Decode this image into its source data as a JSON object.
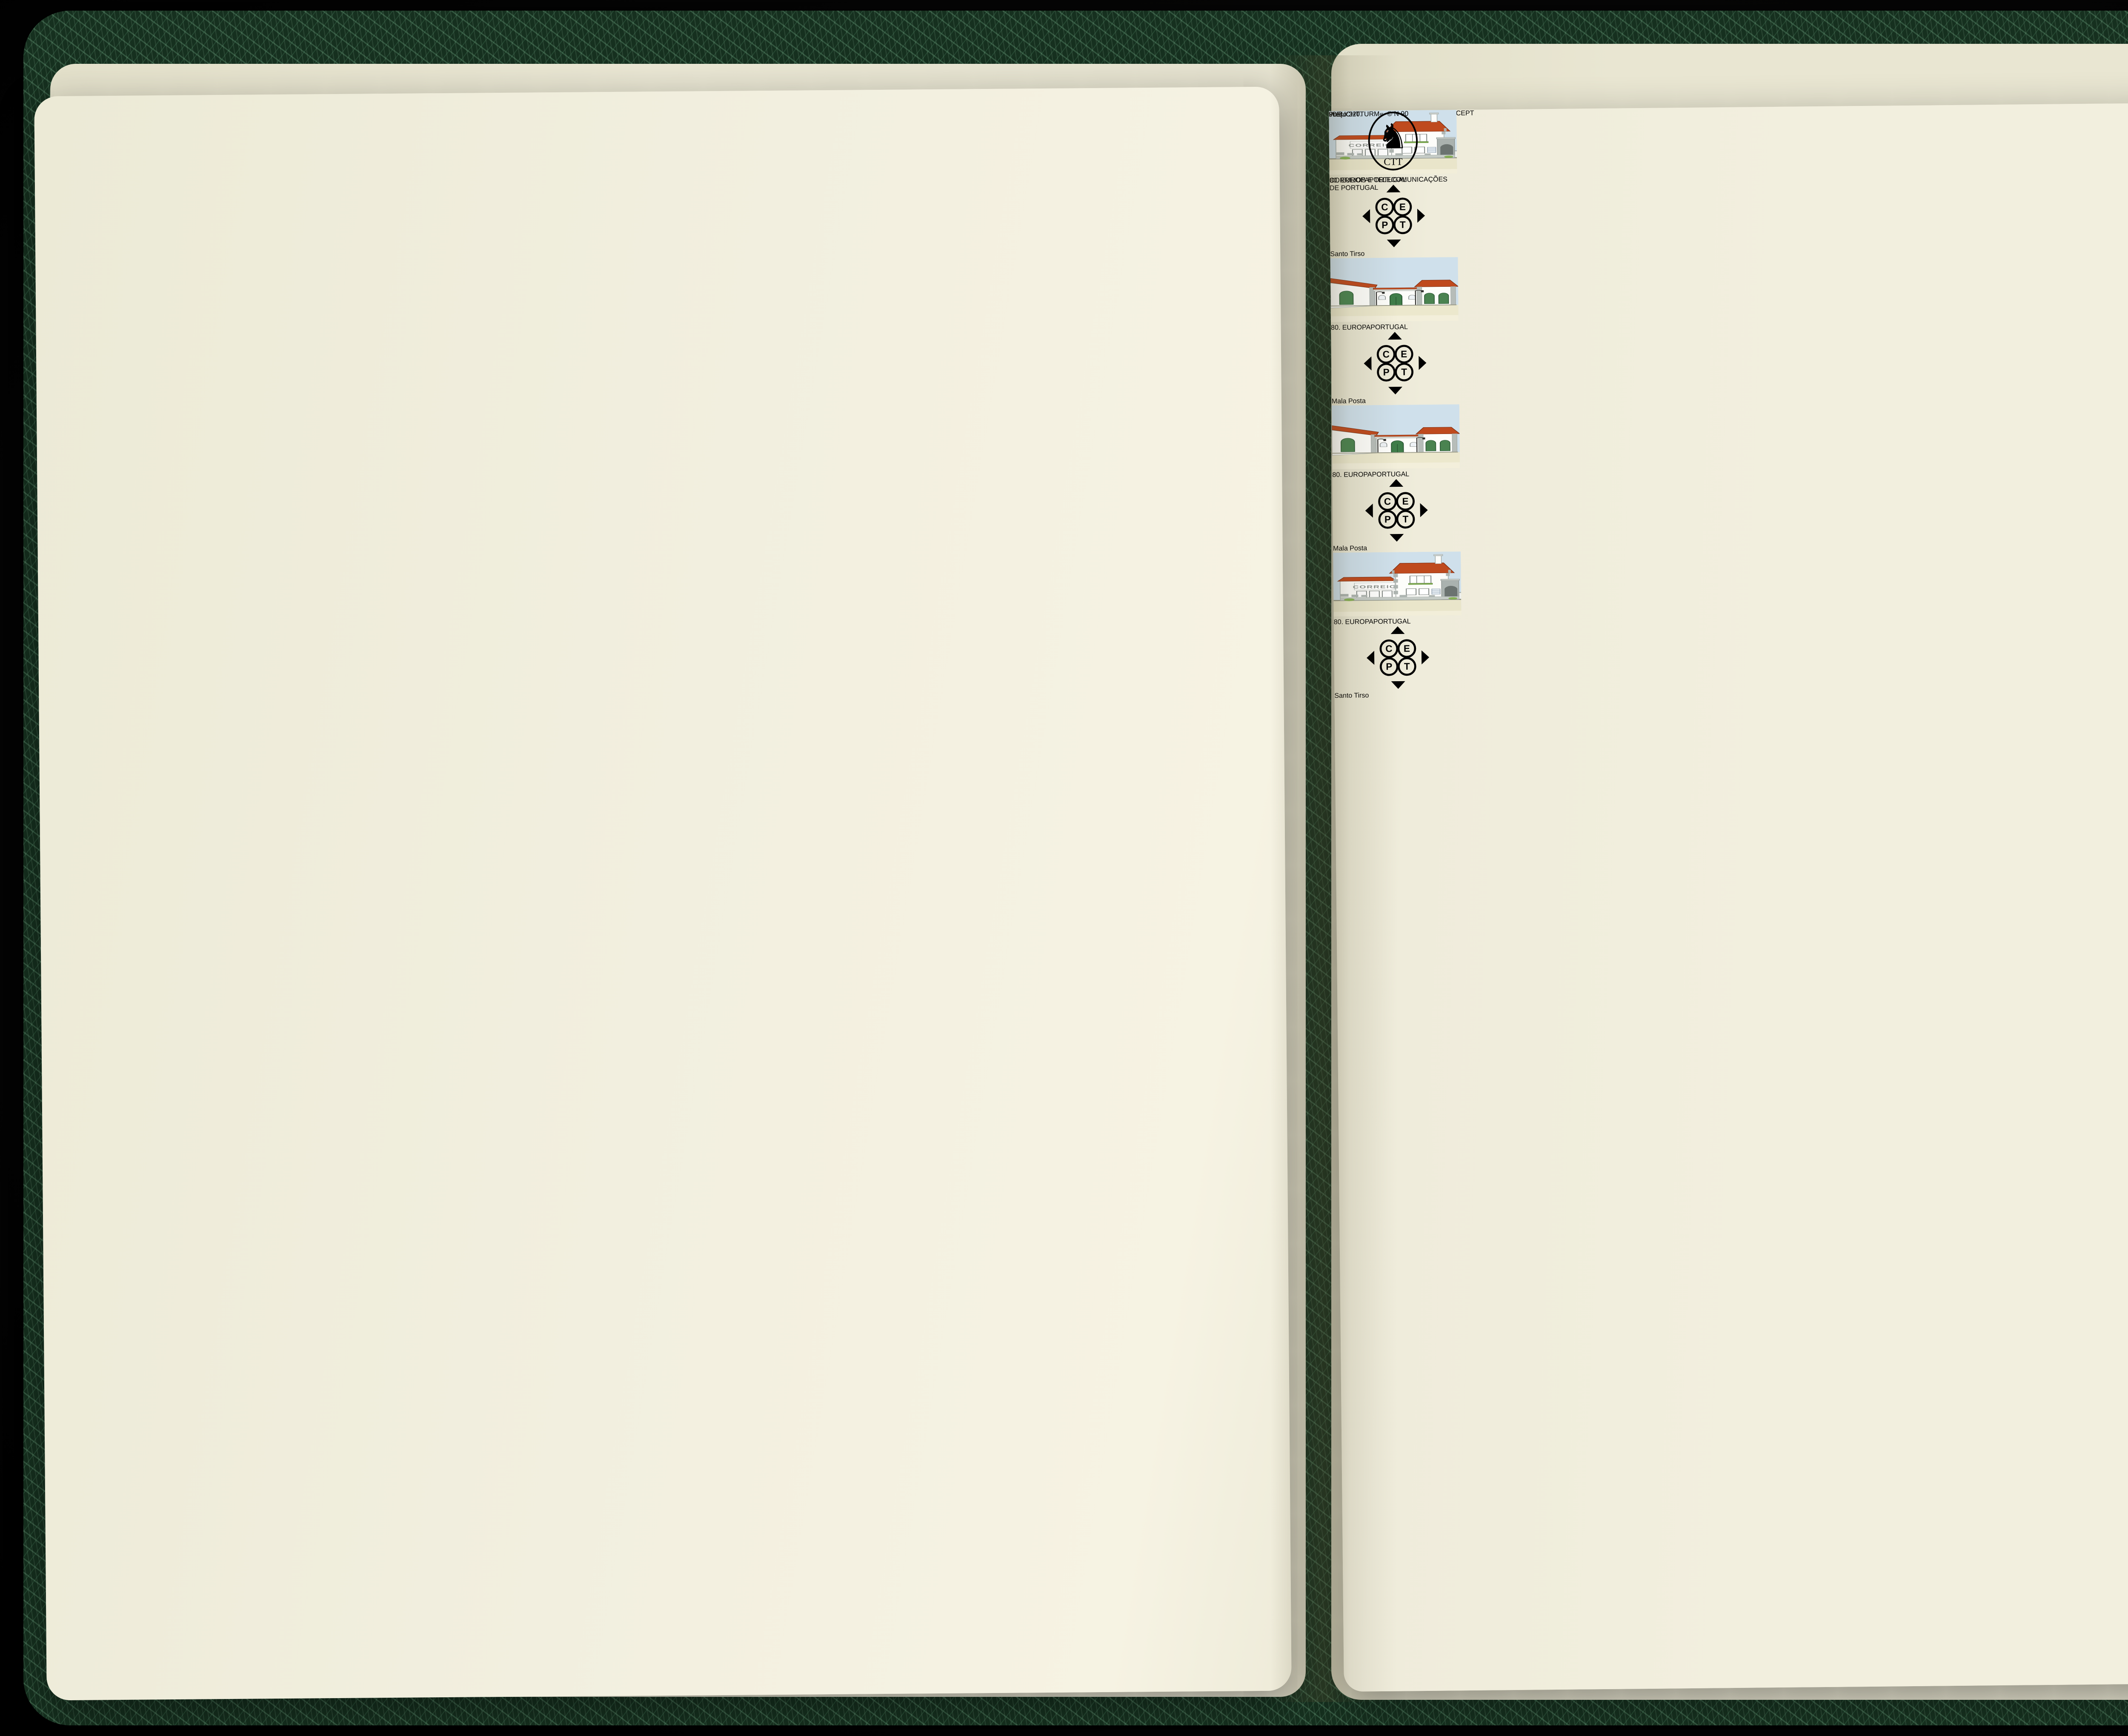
{
  "album": {
    "right_page": {
      "title": "EUROPA",
      "subtitle_left": "CEPT Issues",
      "subtitle_center": "CEPT-Ausgaben",
      "subtitle_right": "Emissions CEPT",
      "year": "1990",
      "country": "Portugal",
      "footer_brand": "»LEUCHTTURM«",
      "footer_code": "© N 90",
      "page_number": "90.8"
    },
    "sheet": {
      "year": "1990",
      "title_left": "EUROPA",
      "title_right": "PORTUGAL",
      "sign_text": "CORREIO",
      "postal_logo_text": "CTT",
      "issuer": "CORREIOS E TELECOMUNICAÇÕES DE PORTUGAL",
      "price": "Preço:320.",
      "stamps": [
        {
          "value": "80.",
          "title_left": "EUROPA",
          "title_right": "PORTUGAL",
          "label": "Santo Tirso",
          "design_ref": "#design-santo-tirso"
        },
        {
          "value": "80.",
          "title_left": "EUROPA",
          "title_right": "PORTUGAL",
          "label": "Mala Posta",
          "design_ref": "#design-mala-posta"
        },
        {
          "value": "80.",
          "title_left": "EUROPA",
          "title_right": "PORTUGAL",
          "label": "Mala Posta",
          "design_ref": "#design-mala-posta"
        },
        {
          "value": "80.",
          "title_left": "EUROPA",
          "title_right": "PORTUGAL",
          "label": "Santo Tirso",
          "design_ref": "#design-santo-tirso"
        }
      ]
    },
    "colors": {
      "cover_green": "#16301f",
      "page_cream": "#f2efde",
      "sheet_white": "#fbfaf2",
      "stamp_sky": "#cfe0eb",
      "roof_red": "#bf4a1e",
      "door_green": "#3f7d49",
      "ground_beige": "#e9e5ca",
      "binding_gold": "#c9b068",
      "value_gray": "#8e9390"
    }
  }
}
